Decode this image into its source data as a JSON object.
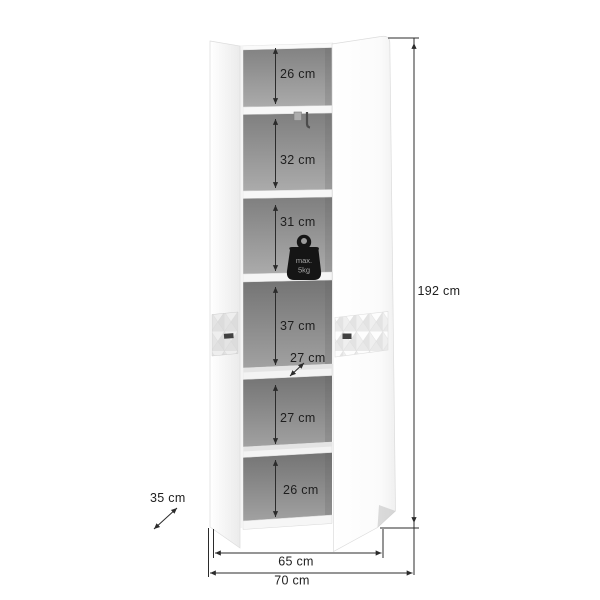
{
  "diagram": {
    "kind": "furniture-dimension-diagram",
    "product": "tall two-door cabinet with six interior shelf sections, doors open"
  },
  "labels": {
    "sections": [
      "26 cm",
      "32 cm",
      "31 cm",
      "37 cm",
      "27 cm",
      "26 cm"
    ],
    "shelf_depth": "27 cm",
    "height": "192 cm",
    "depth": "35 cm",
    "inner_width": "65 cm",
    "outer_width": "70 cm",
    "max_load_line1": "max.",
    "max_load_line2": "5kg"
  },
  "colors": {
    "dimension_line": "#2b2b2b",
    "label_text": "#1e1e1e",
    "interior_gray": "#979797",
    "cabinet_white": "#fbfbfb",
    "max_load_icon": "#151515"
  }
}
